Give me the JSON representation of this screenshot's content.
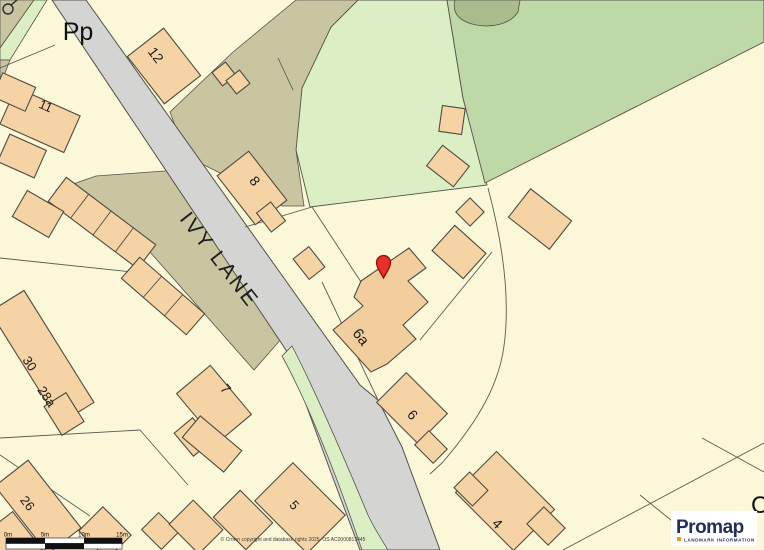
{
  "map": {
    "road_label": "IVY LANE",
    "corner_annotation": "Pp",
    "edge_partial_label": "C",
    "building_labels": {
      "b12": "12",
      "b11": "11",
      "b8": "8",
      "b6a": "6a",
      "b7": "7",
      "b30": "30",
      "b28a": "28a",
      "b26": "26",
      "b5": "5",
      "b6": "6",
      "b4": "4"
    }
  },
  "marker": {
    "type": "location-pin",
    "color": "#E63028"
  },
  "scale_bar": {
    "tick_labels": [
      "0m",
      "5m",
      "10m",
      "15m"
    ]
  },
  "attribution": "© Crown copyright and database rights 2025. OS AC0000813445",
  "branding": {
    "logo_text": "Promap",
    "tagline": "LANDMARK INFORMATION",
    "logo_color": "#232E5C",
    "tagline_bullet_color": "#F7941E"
  },
  "colors": {
    "background": "#FBF8D9",
    "road": "#D4D4D2",
    "building": "#F5D3A4",
    "field_light": "#DBEEC4",
    "field_medium": "#BFD8A8",
    "tree_area": "#A9BC8B",
    "yard": "#C8C5A0",
    "outline": "#55524A"
  }
}
